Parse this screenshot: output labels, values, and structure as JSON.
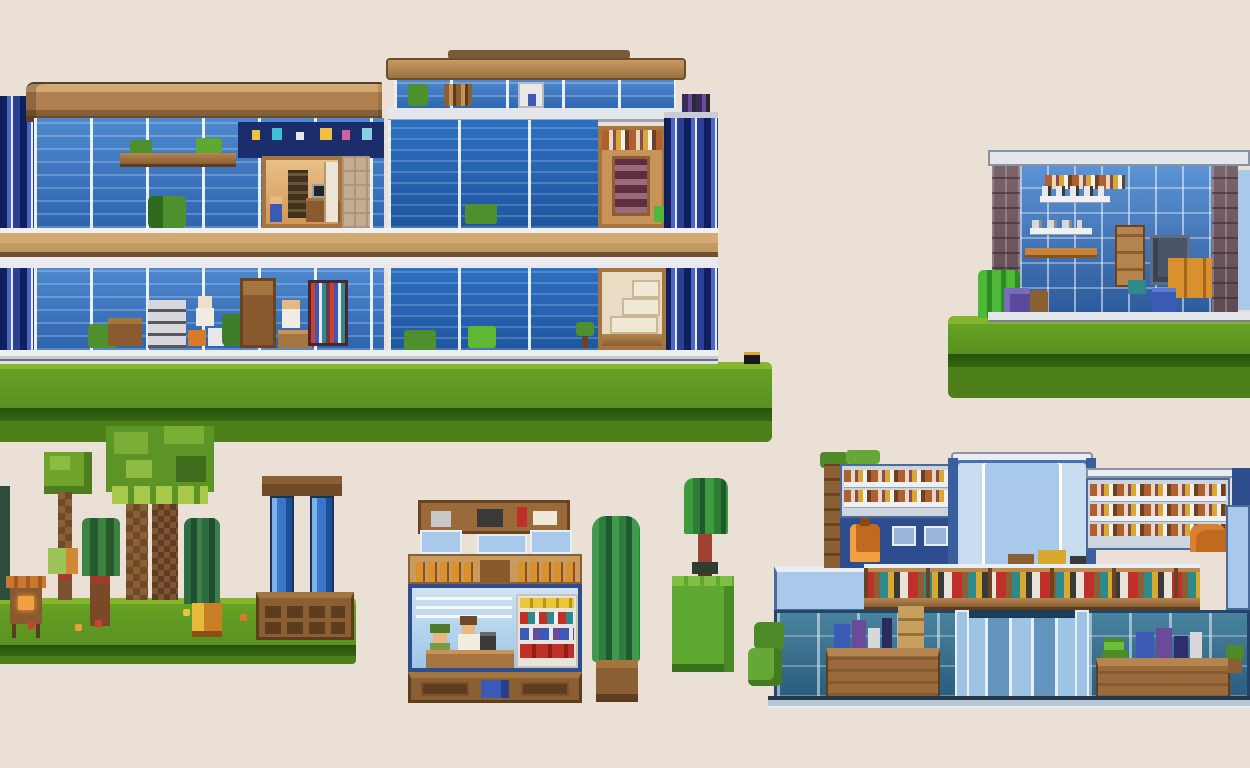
{
  "scene": {
    "style": "pixel-art sprite sheet of buildings, trees and props on a beige background",
    "background_color": "#eae0d5",
    "text_content": "none"
  },
  "palette": {
    "background": "#eae0d5",
    "grass_lip": "#84b52c",
    "grass": "#5f9721",
    "grass_dark_band": "#2e5a12",
    "grass_low": "#4d8019",
    "roof_light": "#d2a873",
    "roof": "#b08050",
    "roof_dark": "#6b4c2c",
    "wood_light": "#b5854f",
    "wood": "#8a5f33",
    "wood_dark": "#5e3d1e",
    "glass_light": "#5b93d4",
    "glass": "#3a76c4",
    "glass_deep": "#2d65ae",
    "navy_interior": "#1b2e6b",
    "column_navy": "#10205e",
    "slab_tan": "#d2ab74",
    "slab_white": "#eceef0",
    "brick": "#6e575e",
    "teal_glass": "#2e6080",
    "tower_blue": "#a9c9ea",
    "mall_navy": "#2e4d8e",
    "leaf_light": "#8ebc43",
    "leaf": "#5c9426",
    "leaf_dark": "#3f6b1c",
    "pine_green": "#2f6b35",
    "cypress_green": "#2e7d3f",
    "bright_green": "#5fa832",
    "accent_orange": "#d9912e",
    "accent_red": "#c03028",
    "accent_teal": "#2e8a8a",
    "accent_purple": "#6a4a9a",
    "accent_blue": "#3a5ab5",
    "fire_glow": "#f0a040",
    "skin": "#e8b882"
  },
  "objects": {
    "office_building": {
      "label": "two-story blue glass office building with brown roof, rooftop penthouse and furnished interiors"
    },
    "grass_main": {
      "label": "wide green grass platform under the office building"
    },
    "storage_room": {
      "label": "single-room workshop with brick pillars, blue glass wall and stacked crates"
    },
    "grass_right": {
      "label": "green grass platform under the workshop room"
    },
    "park": {
      "label": "pixel trees, market stall and two blue glass pillars on a grass platform"
    },
    "cafe": {
      "label": "small cafe shop with bottle shelf, barista, customer and product racks"
    },
    "cypress": {
      "label": "tall dark cypress tree in a wooden pot"
    },
    "sapling": {
      "label": "small red-trunk tree on a bright green grass block"
    },
    "mall": {
      "label": "large shopping mall with central glass tower, mezzanine shops, entrance doors and counters"
    }
  }
}
